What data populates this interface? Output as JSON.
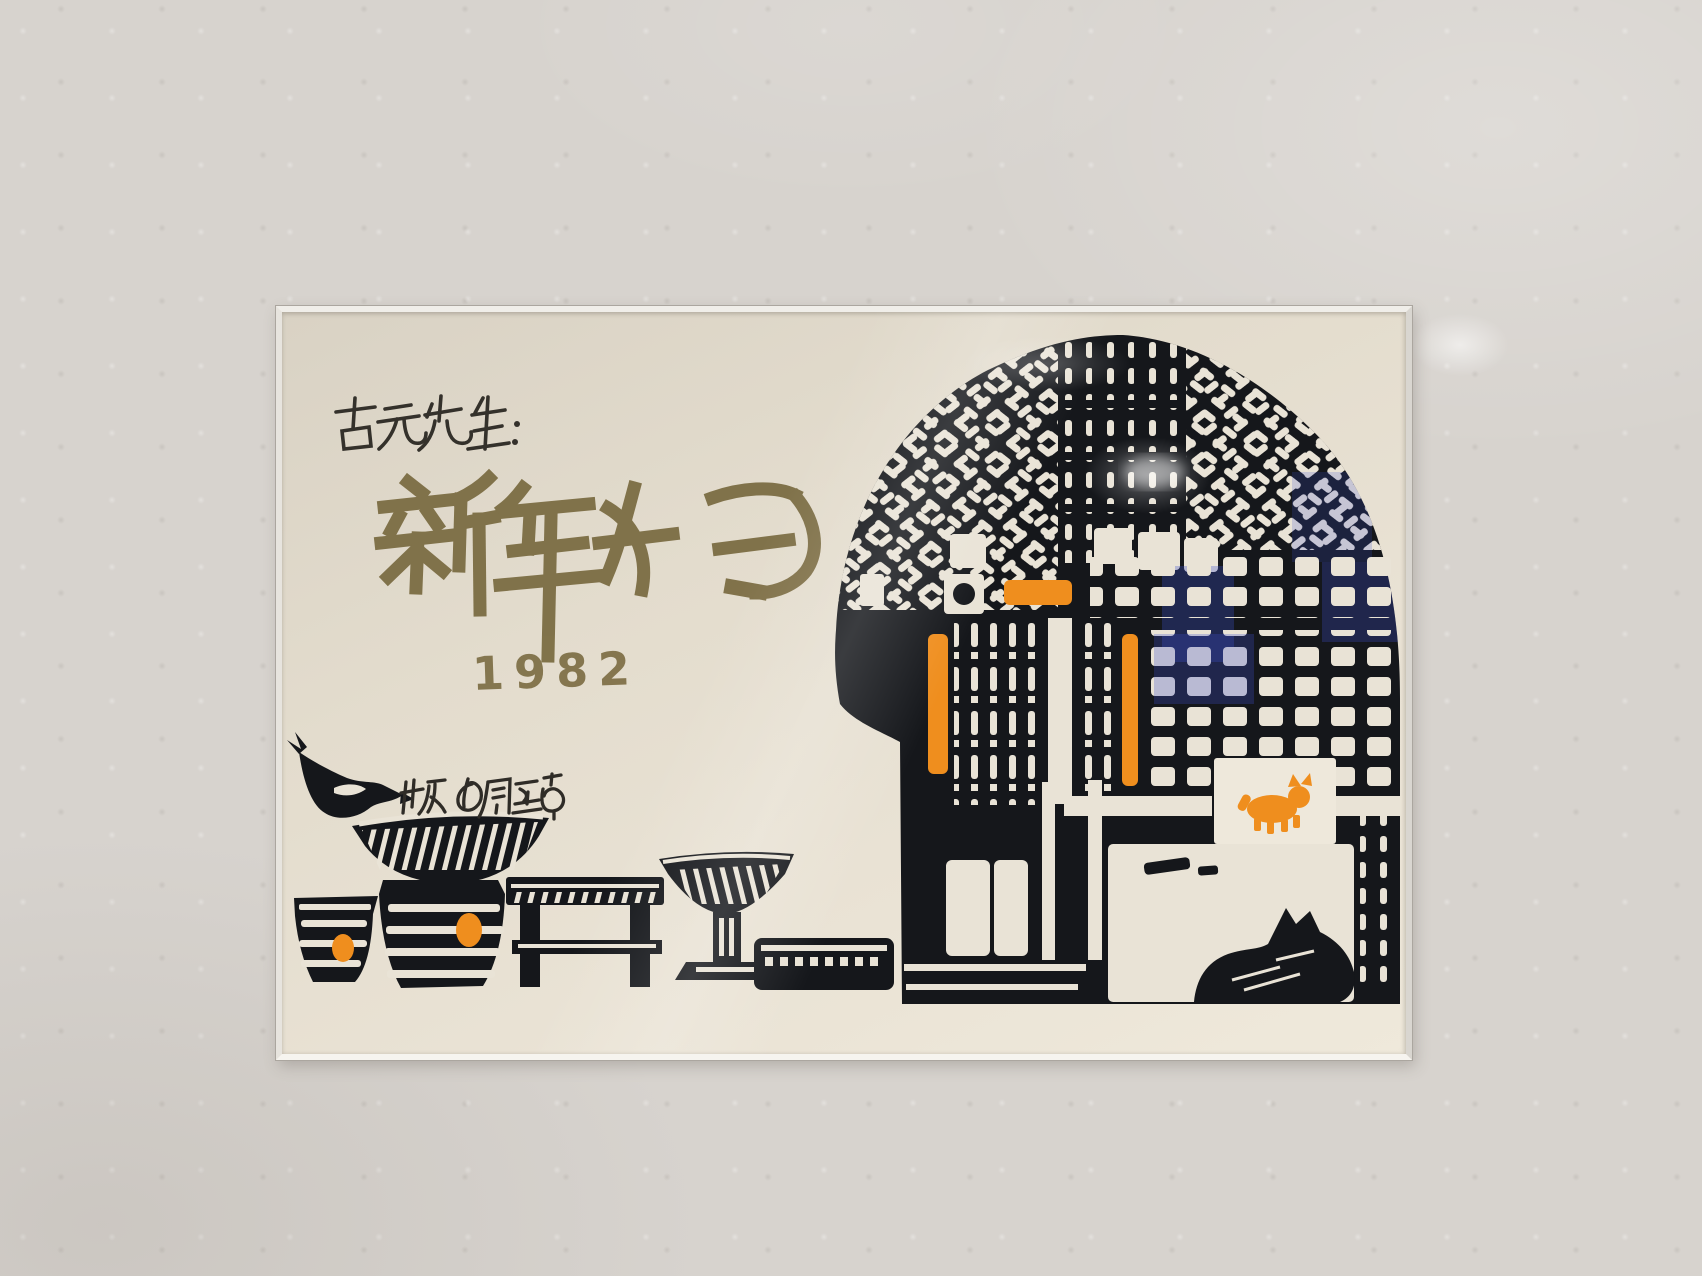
{
  "scene": {
    "setting": "Framed woodblock-print New Year card photographed on a gallery wall",
    "wall": {
      "color": "#d7d3ce"
    },
    "frame": {
      "style": "thin light metal frame",
      "color": "#eceae4"
    },
    "artwork": {
      "kind": "woodblock print greeting card",
      "inscription": "古元先生:",
      "greeting": "新年好",
      "year": "1982",
      "signature": "版の周至南",
      "palette": {
        "paper": "#e7e0d3",
        "ink": "#34312b",
        "calligraphy_olive": "#7d6e45",
        "print_black": "#15171b",
        "accent_orange": "#ef8e1e",
        "glass_reflection_blue": "#3c50cc"
      },
      "motifs": [
        "arched lattice pavilion gate",
        "slatted doors with orange bars",
        "white signboard with orange dog",
        "black dog resting at the gate",
        "bird perched on woven basket",
        "striped cups and jar with orange dots",
        "wooden bench",
        "pedestal bowl",
        "feeding trough"
      ]
    }
  }
}
